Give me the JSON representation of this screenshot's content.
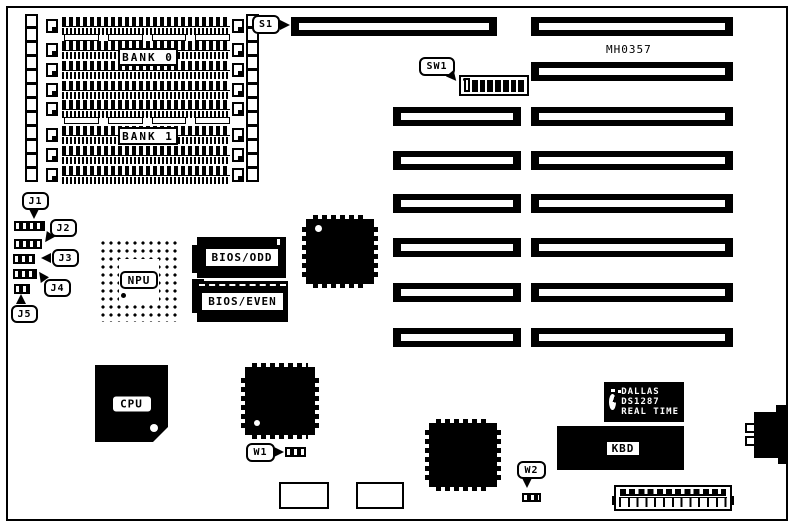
{
  "colors": {
    "ink": "#000000",
    "paper": "#ffffff"
  },
  "board": {
    "part_number": "MH0357"
  },
  "memory": {
    "bank0": "BANK 0",
    "bank1": "BANK 1"
  },
  "chips": {
    "npu": "NPU",
    "cpu": "CPU",
    "bios_odd": "BIOS/ODD",
    "bios_even": "BIOS/EVEN",
    "kbd": "KBD"
  },
  "rtc": {
    "brand": "DALLAS",
    "model": "DS1287",
    "type": "REAL TIME"
  },
  "callouts": {
    "s1": "S1",
    "sw1": "SW1",
    "j1": "J1",
    "j2": "J2",
    "j3": "J3",
    "j4": "J4",
    "j5": "J5",
    "w1": "W1",
    "w2": "W2"
  }
}
